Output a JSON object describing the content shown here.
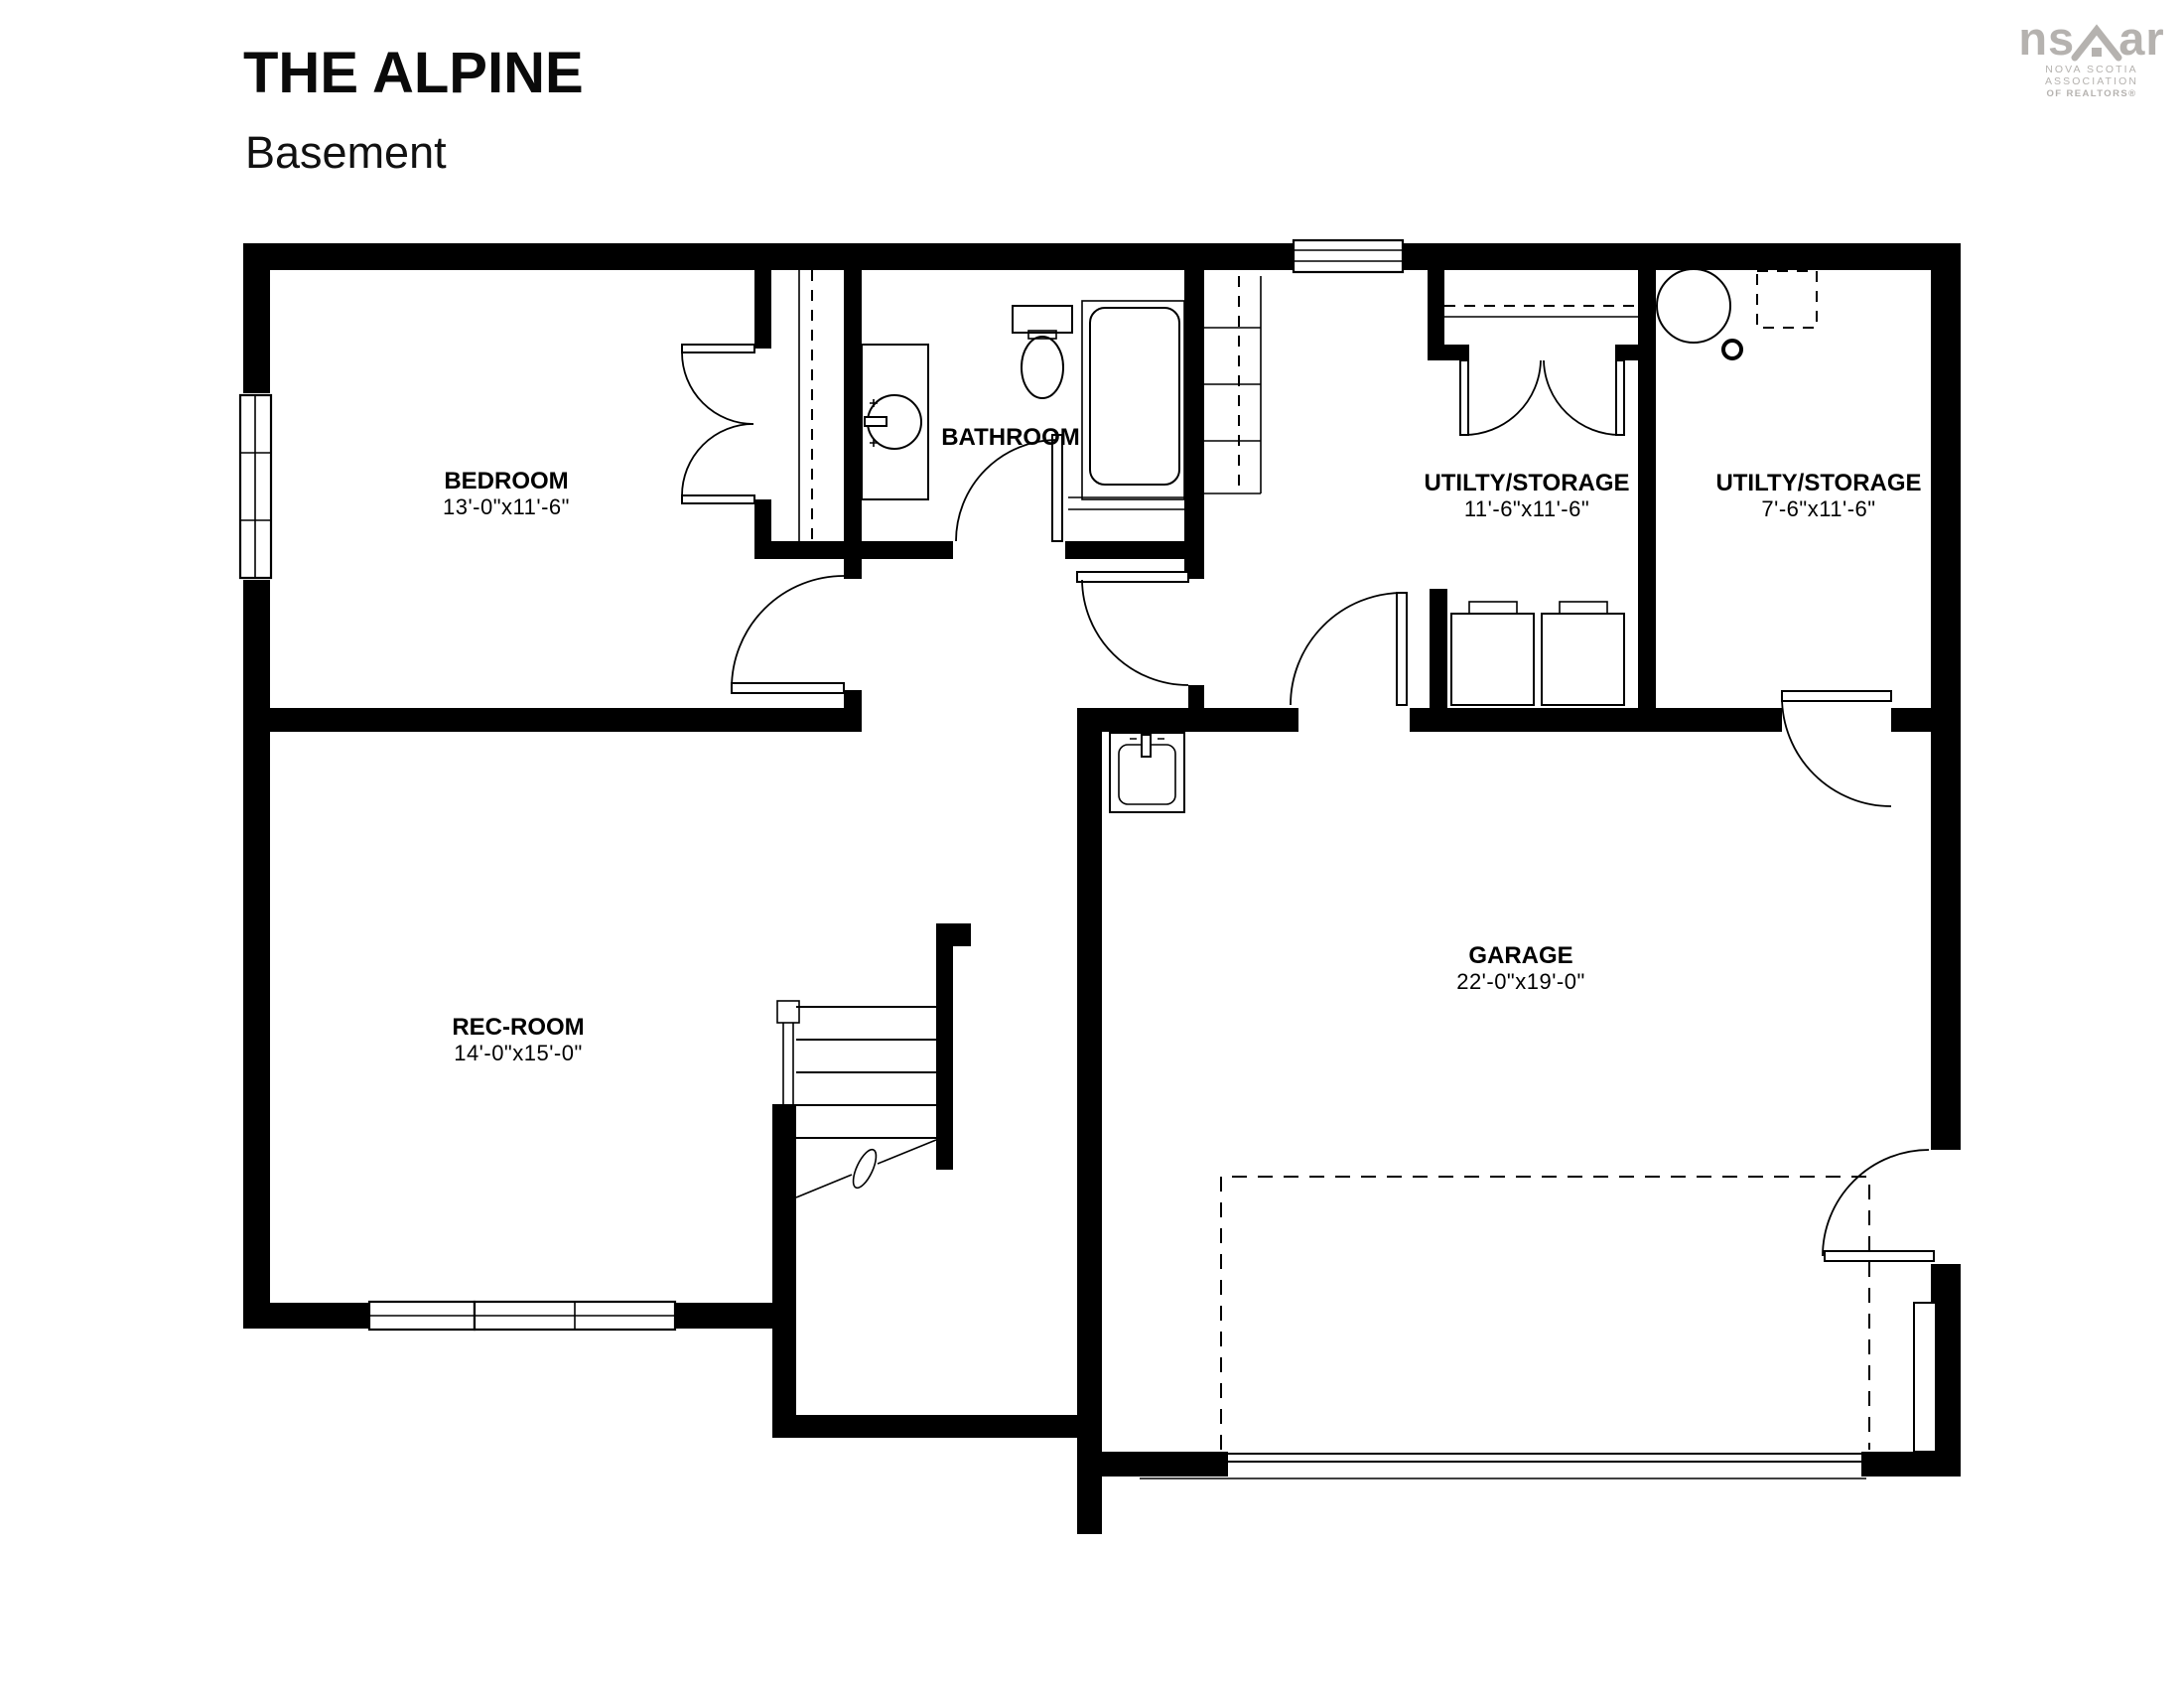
{
  "header": {
    "title": "THE ALPINE",
    "subtitle": "Basement"
  },
  "logo": {
    "brand_left": "ns",
    "brand_right": "ar",
    "line1": "NOVA SCOTIA ASSOCIATION",
    "line2": "OF REALTORS®"
  },
  "rooms": {
    "bedroom": {
      "name": "BEDROOM",
      "dims": "13'-0\"x11'-6\""
    },
    "bathroom": {
      "name": "BATHROOM",
      "dims": ""
    },
    "utility1": {
      "name": "UTILTY/STORAGE",
      "dims": "11'-6\"x11'-6\""
    },
    "utility2": {
      "name": "UTILTY/STORAGE",
      "dims": "7'-6\"x11'-6\""
    },
    "recroom": {
      "name": "REC-ROOM",
      "dims": "14'-0\"x15'-0\""
    },
    "garage": {
      "name": "GARAGE",
      "dims": "22'-0\"x19'-0\""
    }
  }
}
